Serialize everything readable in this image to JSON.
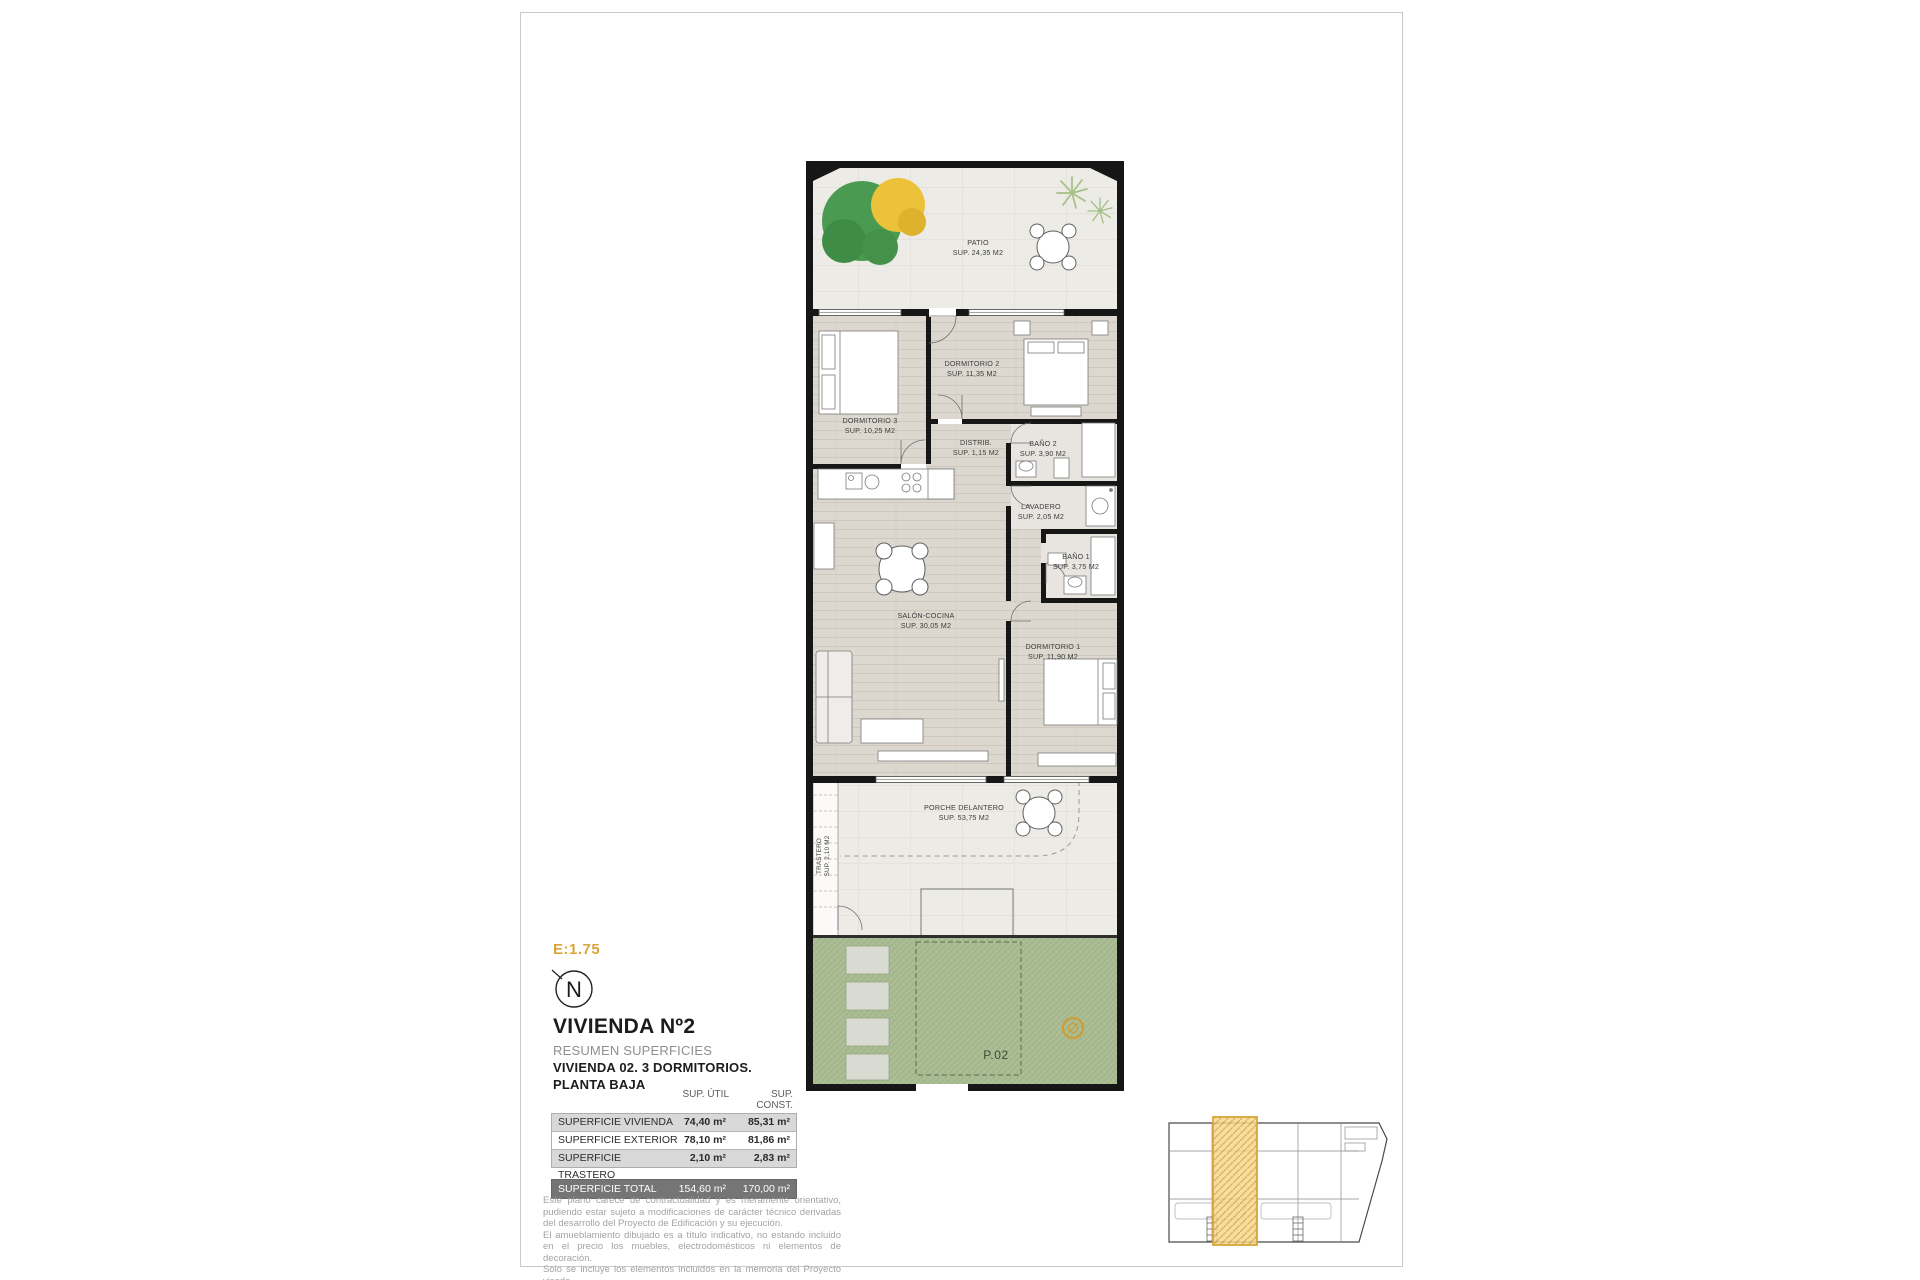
{
  "sheet": {
    "scale_label": "E:1.75",
    "north_letter": "N"
  },
  "titleblock": {
    "title": "VIVIENDA Nº2",
    "subtitle1": "RESUMEN SUPERFICIES",
    "subtitle2": "VIVIENDA 02. 3 DORMITORIOS.",
    "subtitle3": "PLANTA BAJA"
  },
  "floor_plan": {
    "rooms": [
      {
        "name": "PATIO",
        "area": "SUP. 24,35 M2"
      },
      {
        "name": "DORMITORIO 2",
        "area": "SUP. 11,35 M2"
      },
      {
        "name": "DORMITORIO 3",
        "area": "SUP. 10,25 M2"
      },
      {
        "name": "DISTRIB.",
        "area": "SUP. 1,15 M2"
      },
      {
        "name": "BAÑO 2",
        "area": "SUP. 3,90 M2"
      },
      {
        "name": "LAVADERO",
        "area": "SUP. 2,05 M2"
      },
      {
        "name": "BAÑO 1",
        "area": "SUP. 3,75 M2"
      },
      {
        "name": "SALÓN-COCINA",
        "area": "SUP. 30,05 M2"
      },
      {
        "name": "DORMITORIO 1",
        "area": "SUP. 11,90 M2"
      },
      {
        "name": "PORCHE DELANTERO",
        "area": "SUP. 53,75 M2"
      },
      {
        "name": "TRASTERO",
        "area": "SUP. 2,10 M2"
      }
    ],
    "parking_label": "P.02"
  },
  "surface_table": {
    "col_headers": [
      "SUP. ÚTIL",
      "SUP. CONST."
    ],
    "rows": [
      {
        "label": "SUPERFICIE VIVIENDA",
        "util": "74,40 m²",
        "const": "85,31 m²"
      },
      {
        "label": "SUPERFICIE EXTERIOR",
        "util": "78,10 m²",
        "const": "81,86 m²"
      },
      {
        "label": "SUPERFICIE TRASTERO",
        "util": "2,10 m²",
        "const": "2,83 m²"
      }
    ],
    "total": {
      "label": "SUPERFICIE TOTAL",
      "util": "154,60 m²",
      "const": "170,00 m²"
    }
  },
  "disclaimer": {
    "p1": "Este plano carece de contractualidad y es meramente orientativo, pudiendo estar sujeto a modificaciones de carácter técnico derivadas del desarrollo del Proyecto de Edificación y su ejecución.",
    "p2": "El amueblamiento dibujado es a título indicativo, no estando incluido en el precio los muebles, electrodomésticos ni elementos de decoración.",
    "p3": "Solo se incluye los elementos incluidos en la memoria del Proyecto visado."
  },
  "colors": {
    "accent_gold": "#D9A43B",
    "garden_green": "#A9BC93",
    "wall_black": "#161616",
    "total_row_bg": "#757575"
  }
}
